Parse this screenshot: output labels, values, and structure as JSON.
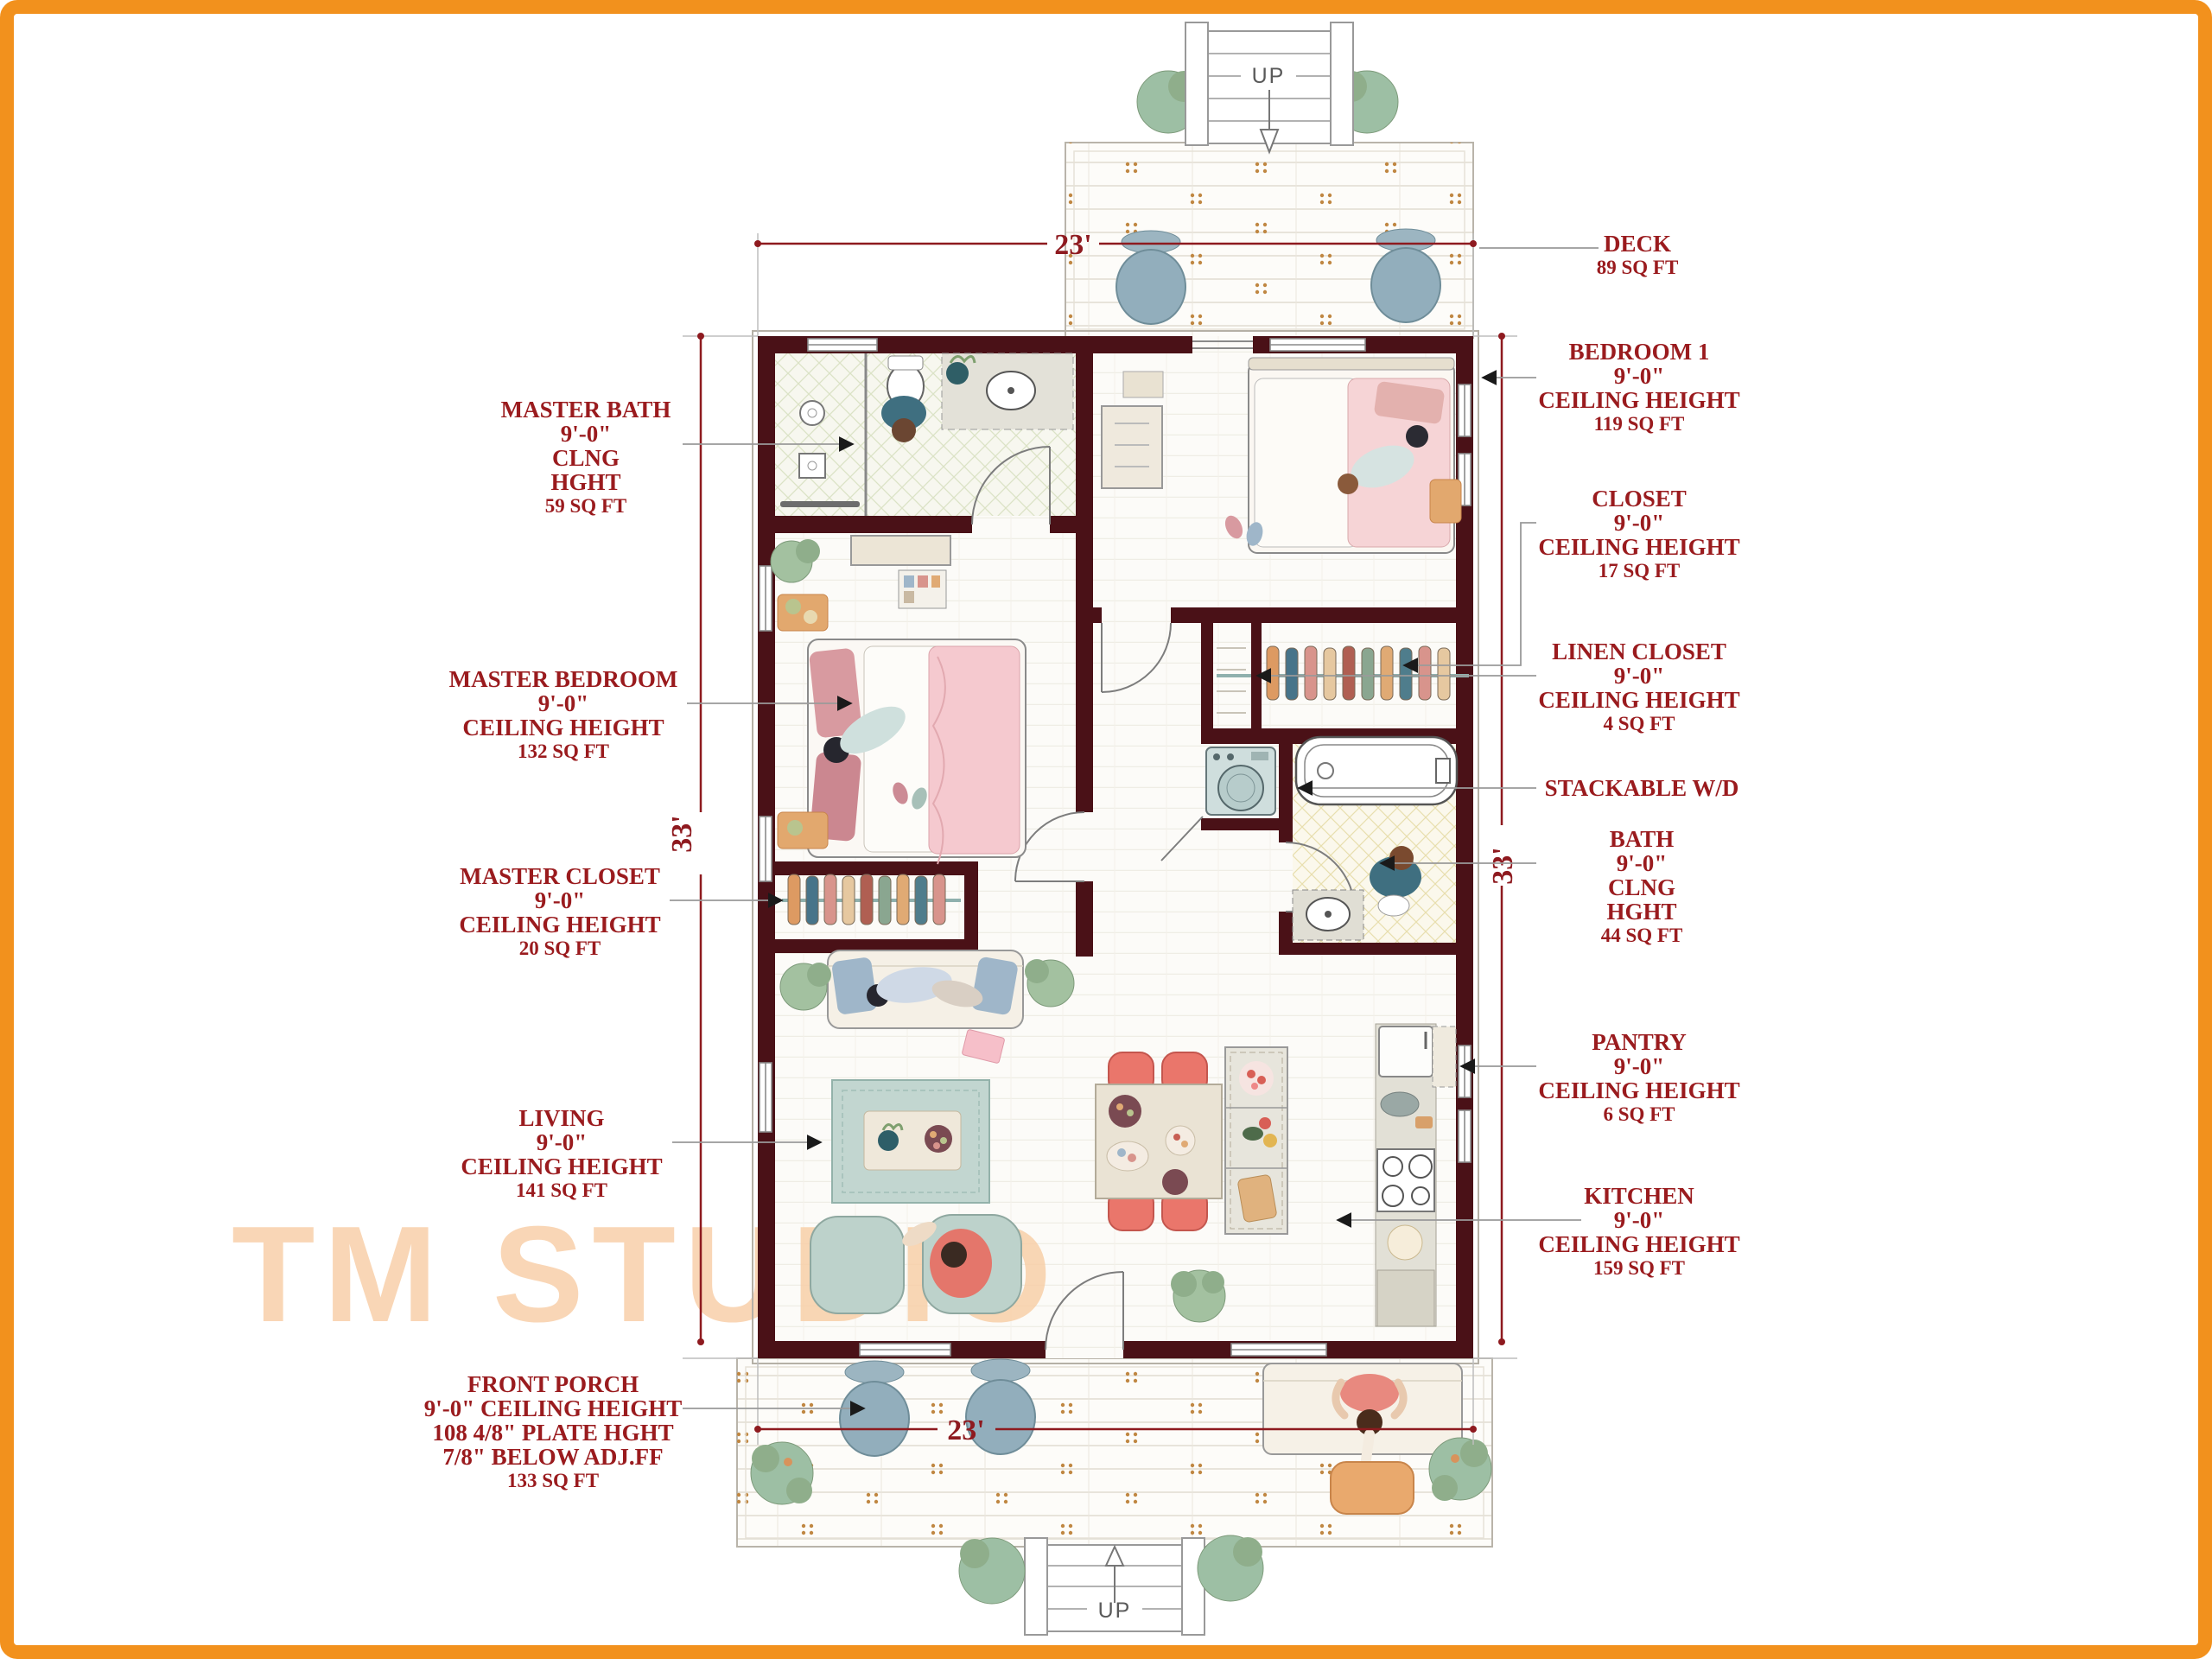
{
  "watermark": {
    "text": "TM STUDIO"
  },
  "dimensions": {
    "top": "23'",
    "bottom": "23'",
    "left": "33'",
    "right": "33'"
  },
  "stairs": {
    "top_label": "UP",
    "bottom_label": "UP"
  },
  "labels": {
    "deck": {
      "lines": [
        "DECK",
        "89 SQ FT"
      ]
    },
    "bedroom1": {
      "lines": [
        "BEDROOM 1",
        "9'-0\"",
        "CEILING HEIGHT",
        "119 SQ FT"
      ]
    },
    "closet": {
      "lines": [
        "CLOSET",
        "9'-0\"",
        "CEILING HEIGHT",
        "17 SQ FT"
      ]
    },
    "linen_closet": {
      "lines": [
        "LINEN CLOSET",
        "9'-0\"",
        "CEILING HEIGHT",
        "4 SQ FT"
      ]
    },
    "stackable_wd": {
      "lines": [
        "STACKABLE W/D"
      ]
    },
    "bath": {
      "lines": [
        "BATH",
        "9'-0\"",
        "CLNG",
        "HGHT",
        "44 SQ FT"
      ]
    },
    "pantry": {
      "lines": [
        "PANTRY",
        "9'-0\"",
        "CEILING HEIGHT",
        "6 SQ FT"
      ]
    },
    "kitchen": {
      "lines": [
        "KITCHEN",
        "9'-0\"",
        "CEILING HEIGHT",
        "159 SQ FT"
      ]
    },
    "master_bath": {
      "lines": [
        "MASTER BATH",
        "9'-0\"",
        "CLNG",
        "HGHT",
        "59 SQ FT"
      ]
    },
    "master_bedroom": {
      "lines": [
        "MASTER BEDROOM",
        "9'-0\"",
        "CEILING HEIGHT",
        "132 SQ FT"
      ]
    },
    "master_closet": {
      "lines": [
        "MASTER CLOSET",
        "9'-0\"",
        "CEILING HEIGHT",
        "20 SQ FT"
      ]
    },
    "living": {
      "lines": [
        "LIVING",
        "9'-0\"",
        "CEILING HEIGHT",
        "141 SQ FT"
      ]
    },
    "front_porch": {
      "lines": [
        "FRONT PORCH",
        "9'-0\" CEILING HEIGHT",
        "108 4/8\" PLATE HGHT",
        "7/8\" BELOW ADJ.FF",
        "133 SQ FT"
      ]
    }
  },
  "colors": {
    "frame": "#F2911D",
    "wall": "#4A1117",
    "label_text": "#9A1B1E",
    "dimension_line": "#8E1A1F",
    "watermark": "#F8CDA4"
  }
}
